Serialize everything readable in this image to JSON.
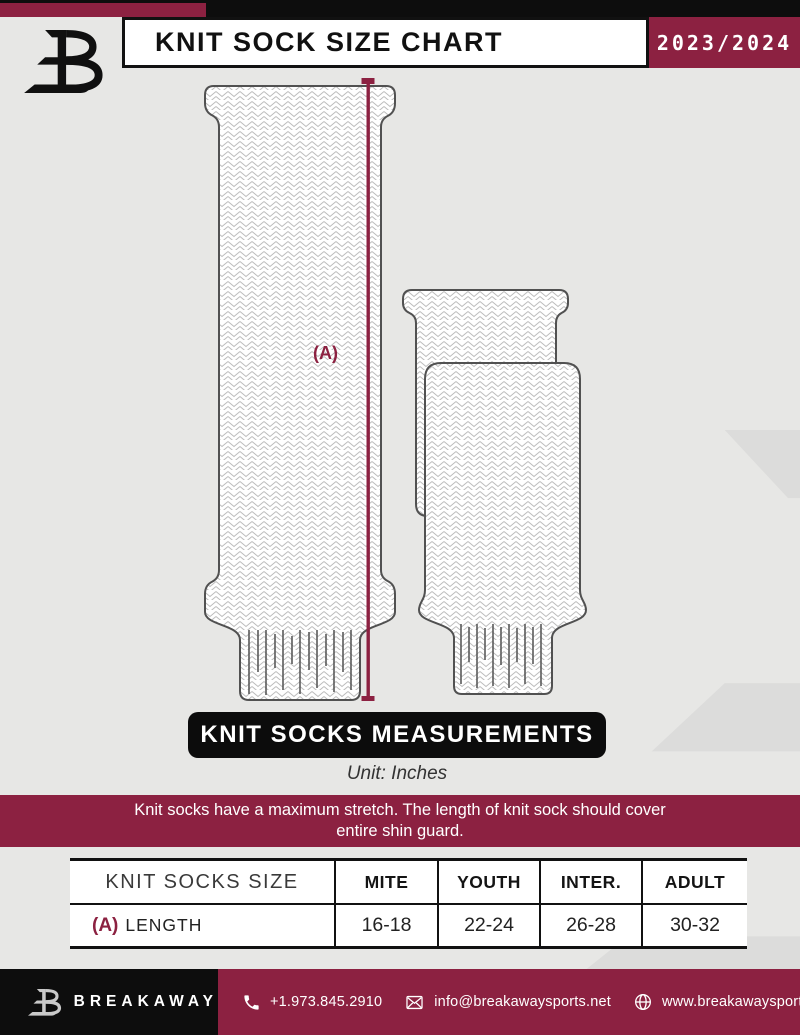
{
  "header": {
    "title": "KNIT SOCK SIZE CHART",
    "season": "2023/2024"
  },
  "diagram": {
    "measurement_label": "(A)"
  },
  "measurements_banner": {
    "title": "KNIT SOCKS MEASUREMENTS",
    "unit": "Unit: Inches"
  },
  "note": {
    "line1": "Knit socks have a maximum stretch. The length of knit sock should cover",
    "line2": "entire shin guard."
  },
  "table": {
    "header": [
      "KNIT SOCKS SIZE",
      "MITE",
      "YOUTH",
      "INTER.",
      "ADULT"
    ],
    "rows": [
      {
        "key": "(A)",
        "label": "LENGTH",
        "values": [
          "16-18",
          "22-24",
          "26-28",
          "30-32"
        ]
      }
    ]
  },
  "footer": {
    "brand": "BREAKAWAY",
    "phone": "+1.973.845.2910",
    "email": "info@breakawaysports.net",
    "website": "www.breakawaysports.net"
  },
  "icons": {
    "phone": "phone-icon",
    "email": "envelope-icon",
    "website": "globe-icon"
  },
  "colors": {
    "maroon": "#8c2141",
    "ink": "#0d0d0d",
    "background": "#e7e7e5"
  }
}
